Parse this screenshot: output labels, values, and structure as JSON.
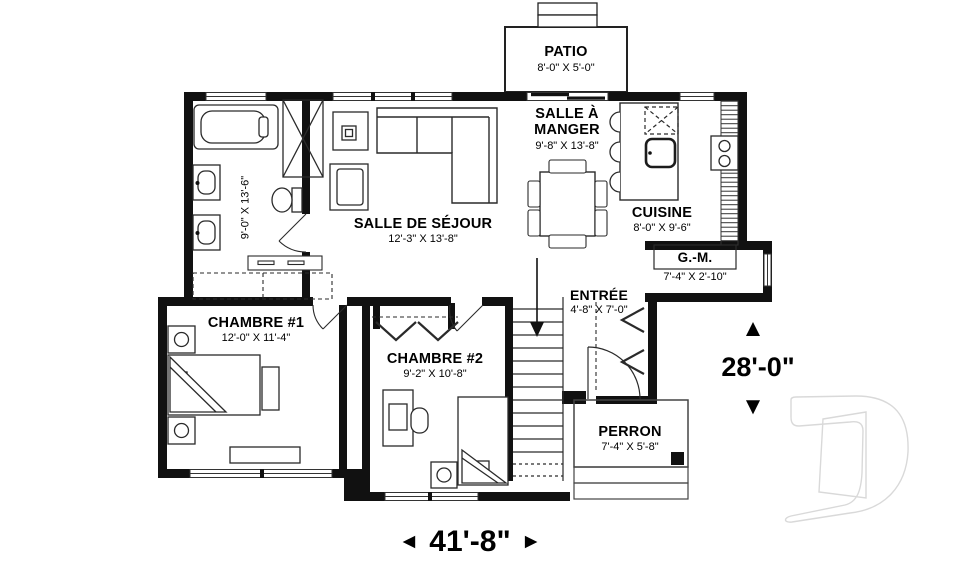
{
  "plan_title": "floor-plan-main-level",
  "rooms": {
    "patio": {
      "name": "PATIO",
      "dims": "8'-0\" X 5'-0\""
    },
    "salle_a_manger": {
      "name": "SALLE À MANGER",
      "dims": "9'-8\" X 13'-8\""
    },
    "cuisine": {
      "name": "CUISINE",
      "dims": "8'-0\" X 9'-6\""
    },
    "salle_de_sejour": {
      "name": "SALLE DE SÉJOUR",
      "dims": "12'-3\" X 13'-8\""
    },
    "salle_de_bain": {
      "dims": "9'-0\" X 13'-6\""
    },
    "gm": {
      "name": "G.-M.",
      "dims": "7'-4\" X 2'-10\""
    },
    "entree": {
      "name": "ENTRÉE",
      "dims": "4'-8\" X 7'-0\""
    },
    "chambre1": {
      "name": "CHAMBRE #1",
      "dims": "12'-0\" X 11'-4\""
    },
    "chambre2": {
      "name": "CHAMBRE #2",
      "dims": "9'-2\" X 10'-8\""
    },
    "perron": {
      "name": "PERRON",
      "dims": "7'-4\" X 5'-8\""
    }
  },
  "overall_dimensions": {
    "width": "41'-8\"",
    "height": "28'-0\""
  },
  "icons": {
    "arrow_left": "◄",
    "arrow_right": "►",
    "arrow_up": "▲",
    "arrow_down": "▼"
  },
  "colors": {
    "wall": "#111111",
    "line": "#2a2a2a",
    "watermark": "#d9d9d9",
    "background": "#ffffff"
  }
}
